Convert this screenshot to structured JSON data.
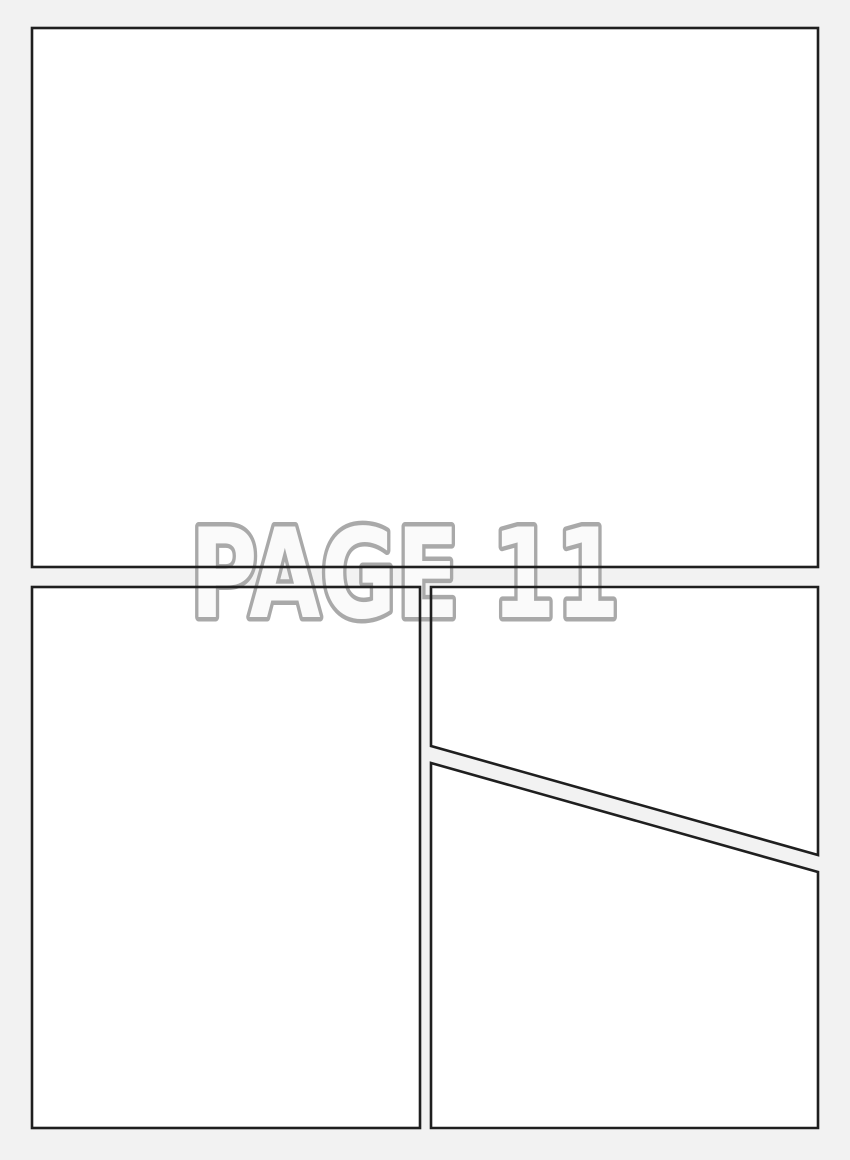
{
  "watermark": {
    "text": "PAGE 11"
  },
  "panels": {
    "count": 4,
    "names": [
      "top-full-width",
      "bottom-left",
      "bottom-right-upper",
      "bottom-right-lower"
    ]
  },
  "colors": {
    "background": "#f2f2f2",
    "panel_fill": "#ffffff",
    "panel_border": "#1f1f1f",
    "watermark_fill": "#fafafa",
    "watermark_outline": "#a9a9a9"
  }
}
